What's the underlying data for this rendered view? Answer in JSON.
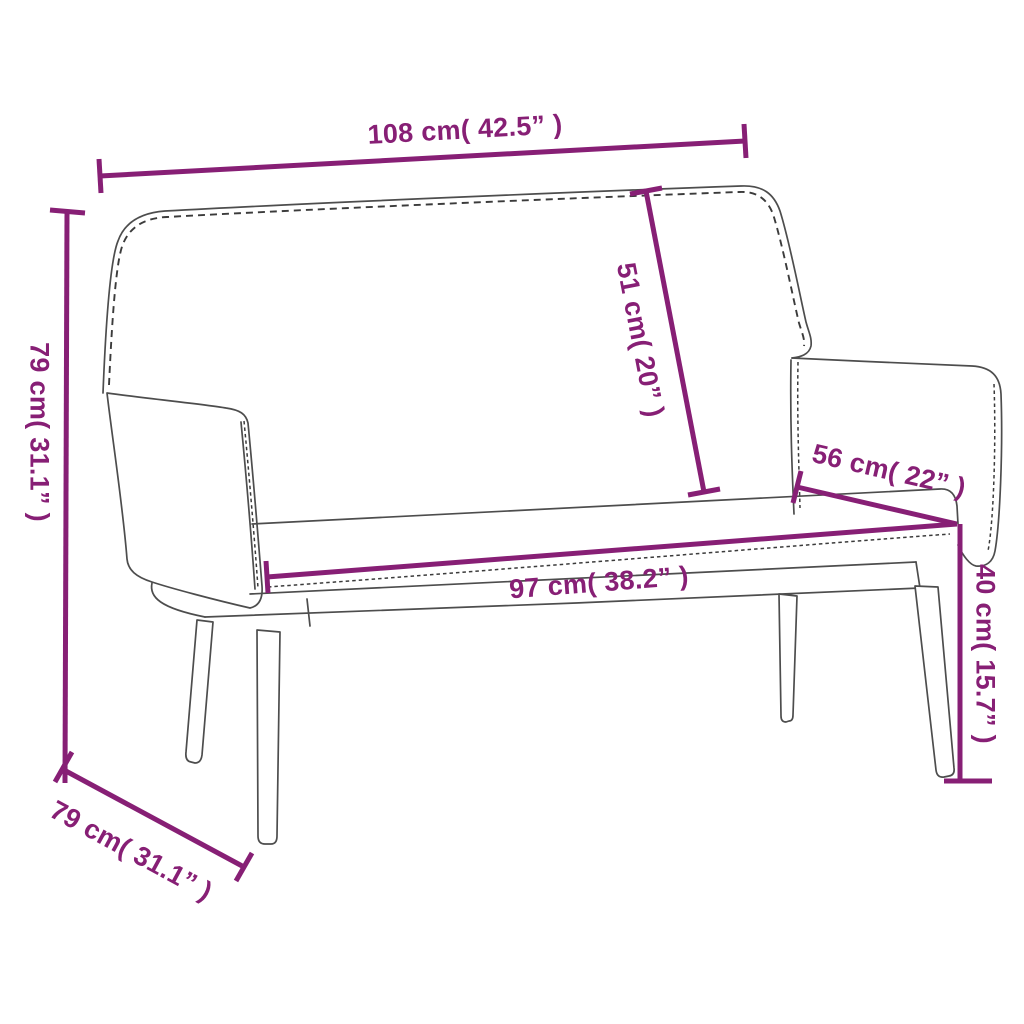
{
  "colors": {
    "accent": "#871F75",
    "outline": "#4D4D4D",
    "stitch": "#3B3B3B",
    "background": "#FFFFFF"
  },
  "diagram": {
    "subject": "upholstered bench with backrest dimension drawing",
    "dimensions": {
      "overall_width": {
        "label": "108 cm( 42.5” )",
        "cm": 108,
        "inches": 42.5
      },
      "overall_height": {
        "label": "79 cm( 31.1” )",
        "cm": 79,
        "inches": 31.1
      },
      "backrest_height": {
        "label": "51 cm( 20” )",
        "cm": 51,
        "inches": 20
      },
      "depth_top": {
        "label": "56 cm( 22” )",
        "cm": 56,
        "inches": 22
      },
      "seat_width": {
        "label": "97 cm( 38.2” )",
        "cm": 97,
        "inches": 38.2
      },
      "seat_height": {
        "label": "40 cm( 15.7” )",
        "cm": 40,
        "inches": 15.7
      },
      "overall_depth": {
        "label": "79 cm( 31.1” )",
        "cm": 79,
        "inches": 31.1
      }
    }
  }
}
